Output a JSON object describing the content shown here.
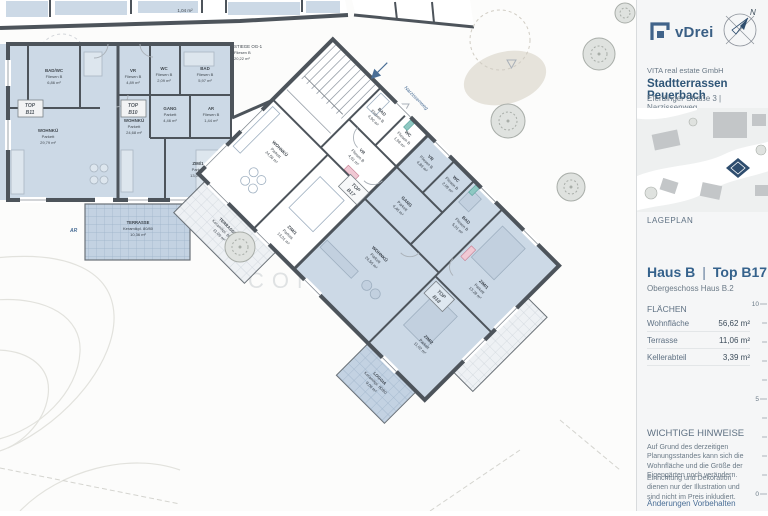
{
  "sidebar": {
    "brand": {
      "logo_text": "vDrei",
      "company": "VITA real estate GmbH",
      "project": "Stadtterrassen Peuerbach",
      "address": "Eferdinger Straße 3 | Narzissenweg",
      "compass_label": "N"
    },
    "siteplan_label": "LAGEPLAN",
    "unit": {
      "haus": "Haus B",
      "separator": "|",
      "top": "Top B17",
      "subtitle": "Obergeschoss Haus B.2"
    },
    "areas": {
      "heading": "FLÄCHEN",
      "rows": [
        {
          "label": "Wohnfläche",
          "value": "56,62 m²"
        },
        {
          "label": "Terrasse",
          "value": "11,06 m²"
        },
        {
          "label": "Kellerabteil",
          "value": "3,39 m²"
        }
      ]
    },
    "notes": {
      "heading": "WICHTIGE HINWEISE",
      "paragraphs": [
        "Auf Grund des derzeitigen Planungsstandes kann sich die Wohnfläche und die Größe der Eigengärten noch verändern.",
        "Einrichtung und Dekoration dienen nur der Illustration und sind nicht im Preis inkludiert."
      ],
      "disclaimer": "Änderungen Vorbehalten"
    },
    "scalebar": {
      "labels": [
        "10",
        "5",
        "0"
      ]
    }
  },
  "plan": {
    "top_fragment_area": "1,04 m²",
    "street_label": "Narzissenweg",
    "ar_marker": "AR",
    "watermark": {
      "line1": "IMMO",
      "line2": "CONTRACT"
    },
    "stiege": {
      "name": "STIEGE OG-1",
      "finish": "Fliesen B",
      "area": "20,22 m²"
    },
    "linkroom": {
      "name": "AR/HM",
      "finish": "Fliesen B",
      "area": "3,04 m²"
    },
    "tops": {
      "b11": {
        "l1": "TOP",
        "l2": "B11"
      },
      "b10": {
        "l1": "TOP",
        "l2": "B10"
      },
      "b17": {
        "l1": "TOP",
        "l2": "B17"
      },
      "b18": {
        "l1": "TOP",
        "l2": "B18"
      }
    },
    "b11": {
      "rooms": [
        {
          "name": "BAD/WC",
          "finish": "Fliesen B",
          "area": "6,86 m²"
        },
        {
          "name": "WOHNKÜ",
          "finish": "Parkett",
          "area": "29,79 m²"
        }
      ],
      "terrace": {
        "name": "TERRASSE",
        "finish": "Keramikpl. 80/80",
        "area": "10,36 m²"
      }
    },
    "b10": {
      "rooms": [
        {
          "name": "VR",
          "finish": "Fliesen B",
          "area": "4,89 m²"
        },
        {
          "name": "WC",
          "finish": "Fliesen B",
          "area": "2,09 m²"
        },
        {
          "name": "BAD",
          "finish": "Fliesen B",
          "area": "5,97 m²"
        },
        {
          "name": "GANG",
          "finish": "Parkett",
          "area": "4,46 m²"
        },
        {
          "name": "AR",
          "finish": "Fliesen B",
          "area": "1,44 m²"
        },
        {
          "name": "WOHNKÜ",
          "finish": "Parkett",
          "area": "24,68 m²"
        },
        {
          "name": "ZIM/1",
          "finish": "Parkett",
          "area": "13,07 m²"
        }
      ]
    },
    "b17": {
      "rooms": [
        {
          "name": "BAD",
          "finish": "Fliesen B",
          "area": "4,90 m²"
        },
        {
          "name": "WC",
          "finish": "Fliesen B",
          "area": "1,98 m²"
        },
        {
          "name": "VR",
          "finish": "Fliesen B",
          "area": "4,61 m²"
        },
        {
          "name": "WOHNKÜ",
          "finish": "Parkett",
          "area": "24,56 m²"
        },
        {
          "name": "ZIM/1",
          "finish": "Parkett",
          "area": "13,01 m²"
        }
      ],
      "terrace": {
        "name": "TERRASSE",
        "finish": "Keramikpl. 80/80",
        "area": "11,06 m²"
      }
    },
    "b18": {
      "rooms": [
        {
          "name": "VR",
          "finish": "Fliesen B",
          "area": "4,89 m²"
        },
        {
          "name": "WC",
          "finish": "Fliesen B",
          "area": "2,09 m²"
        },
        {
          "name": "BAD",
          "finish": "Fliesen B",
          "area": "5,01 m²"
        },
        {
          "name": "GANG",
          "finish": "Parkett",
          "area": "4,46 m²"
        },
        {
          "name": "WOHNKÜ",
          "finish": "Parkett",
          "area": "24,56 m²"
        },
        {
          "name": "ZIM/1",
          "finish": "Parkett",
          "area": "13,28 m²"
        },
        {
          "name": "ZIM/2",
          "finish": "Parkett",
          "area": "11,02 m²"
        }
      ],
      "loggia": {
        "name": "LOGGIA",
        "finish": "Keramikpl. 80/80",
        "area": "9,06 m²"
      }
    },
    "colors": {
      "accent_blue": "#35628c",
      "room_fill": "#ccd9e6",
      "wall": "#4d545b"
    }
  }
}
